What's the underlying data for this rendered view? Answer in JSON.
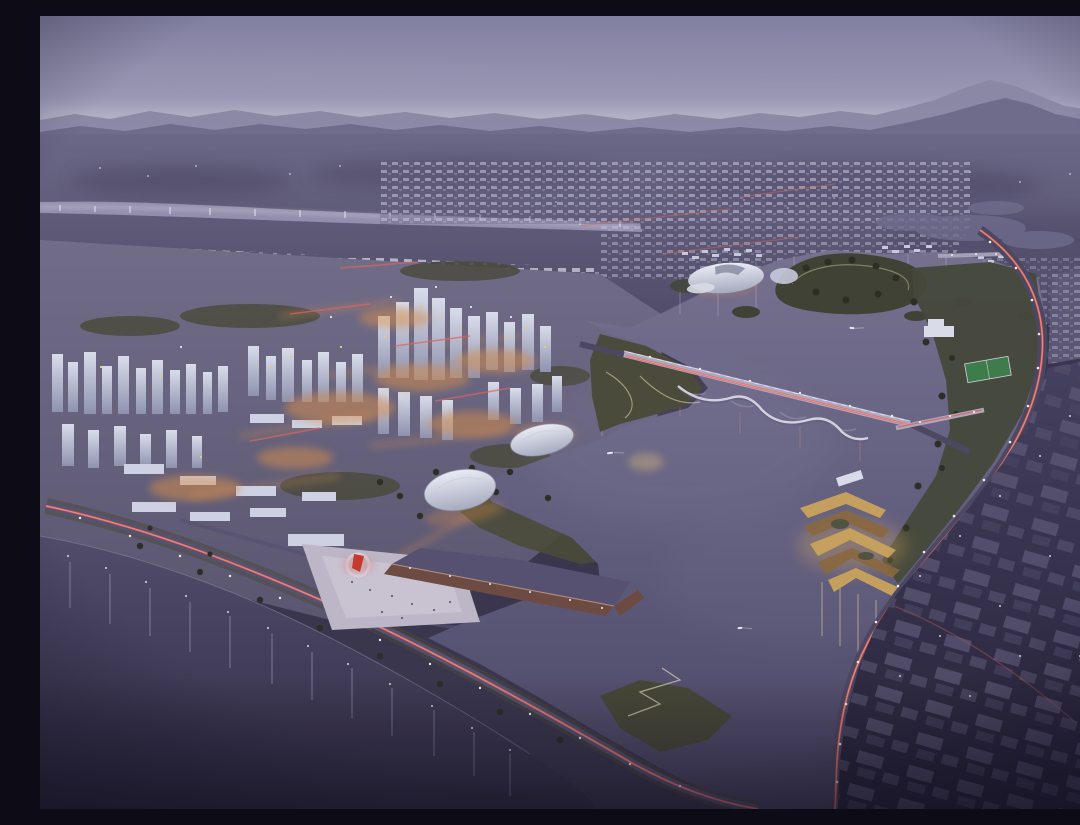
{
  "meta": {
    "title": "Aerial dusk rendering of a lakeside new-town master plan",
    "description": "Oblique bird's-eye architectural visualization at dusk: a dense lit city on the left, a large central lake with a forested island, a long vehicle bridge with red tail-light trails, a scalloped pedestrian bridge, a curving eastern arterial road, a lakeside causeway, an event plaza with a red sculpture, two white dome pavilions, a timber pier basin, golden terraced waterfront pavilions, a dark foreground river with vertical light reflections, and dark low-rise districts on the right.",
    "style": "architectural-visualization",
    "time_of_day": "dusk",
    "view": "aerial-oblique"
  },
  "palette": {
    "sky_top": "#817FA0",
    "sky_mid": "#9C99B6",
    "sky_horizon": "#C2BFD2",
    "haze_band": "#CFCCDC",
    "ridge_far": "#8A87A5",
    "ridge_near": "#6E6B8B",
    "plain_top": "#6B6786",
    "plain_bottom": "#4F4B68",
    "far_city_block": "#C9C7DC",
    "far_river": "#9C98B6",
    "river_sparkle": "#EFEDF7",
    "city_ground_top": "#716D89",
    "city_ground_bottom": "#5A5670",
    "facade_light": "#D9DCEA",
    "facade_shadow": "#8E92AE",
    "slab_white": "#CDD1E3",
    "window_warm": "#E8C87E",
    "glow_orange": "#D98E4A",
    "glow_warm_soft": "#C98A52",
    "streak_red": "#E0635C",
    "streak_red_bright": "#FF9C8F",
    "light_white": "#F2EDDD",
    "park_green": "#49493A",
    "park_green_light": "#6C6C4F",
    "pitch_green": "#3E7C4C",
    "tree_dark": "#2D2F26",
    "path_light": "#C9BD96",
    "lake_top": "#76718F",
    "lake_mid": "#615D7D",
    "lake_deep": "#4A4664",
    "river_top": "#514C6A",
    "river_deep": "#322E46",
    "reflection_cool": "#B9B3D2",
    "reflection_warm": "#D8C49A",
    "plaza_light": "#BCB6C7",
    "plaza_bright": "#CEC9D6",
    "sculpture_red": "#C6392E",
    "pier_brown": "#6E4B42",
    "pier_edge": "#C9A087",
    "dome_hi": "#EAECF4",
    "dome_lo": "#A6AABF",
    "terrace_gold": "#C9A25C",
    "terrace_dark": "#8A683E",
    "road_dark": "#4C4862",
    "district_top": "#454160",
    "district_bottom": "#262238",
    "box_grey": "#5B5774",
    "bridge_deck": "#ACA8C0",
    "bridge_light": "#D9D6E5",
    "boat_white": "#E9E7F1",
    "vignette": "#161226"
  },
  "scene": {
    "sky": [
      "violet dusk haze",
      "mountain ridges on horizon",
      "pale haze band above ridge"
    ],
    "background": [
      "distant plain with scattered lights",
      "glowing river band upper-left",
      "low-rise city grid"
    ],
    "midground": [
      "dense lit CBD towers",
      "residential tower clusters west",
      "white campus slabs",
      "warm street glows"
    ],
    "lake": [
      "large central lake",
      "forested island",
      "wetland ponds northeast",
      "green headlands"
    ],
    "bridges": [
      "main vehicle bridge with red light trails",
      "scalloped pedestrian bridge",
      "east shore bridge",
      "north outlet crossing"
    ],
    "roads": [
      "curving east arterial",
      "diagonal lakeside causeway",
      "red tail-light streaks",
      "white street lights"
    ],
    "waterfront": [
      "lakeside park with winding path",
      "event plaza with red sculpture",
      "timber pier basin",
      "two white dome pavilions",
      "lakeshell pavilion",
      "golden terraced pavilion",
      "sports pitch",
      "zigzag shore path"
    ],
    "river": [
      "dark foreground river",
      "vertical light reflections",
      "shore lights"
    ],
    "districts": [
      "dark warehouse rows bottom-right",
      "low-rise strip northeast"
    ],
    "boats_count": 3
  }
}
